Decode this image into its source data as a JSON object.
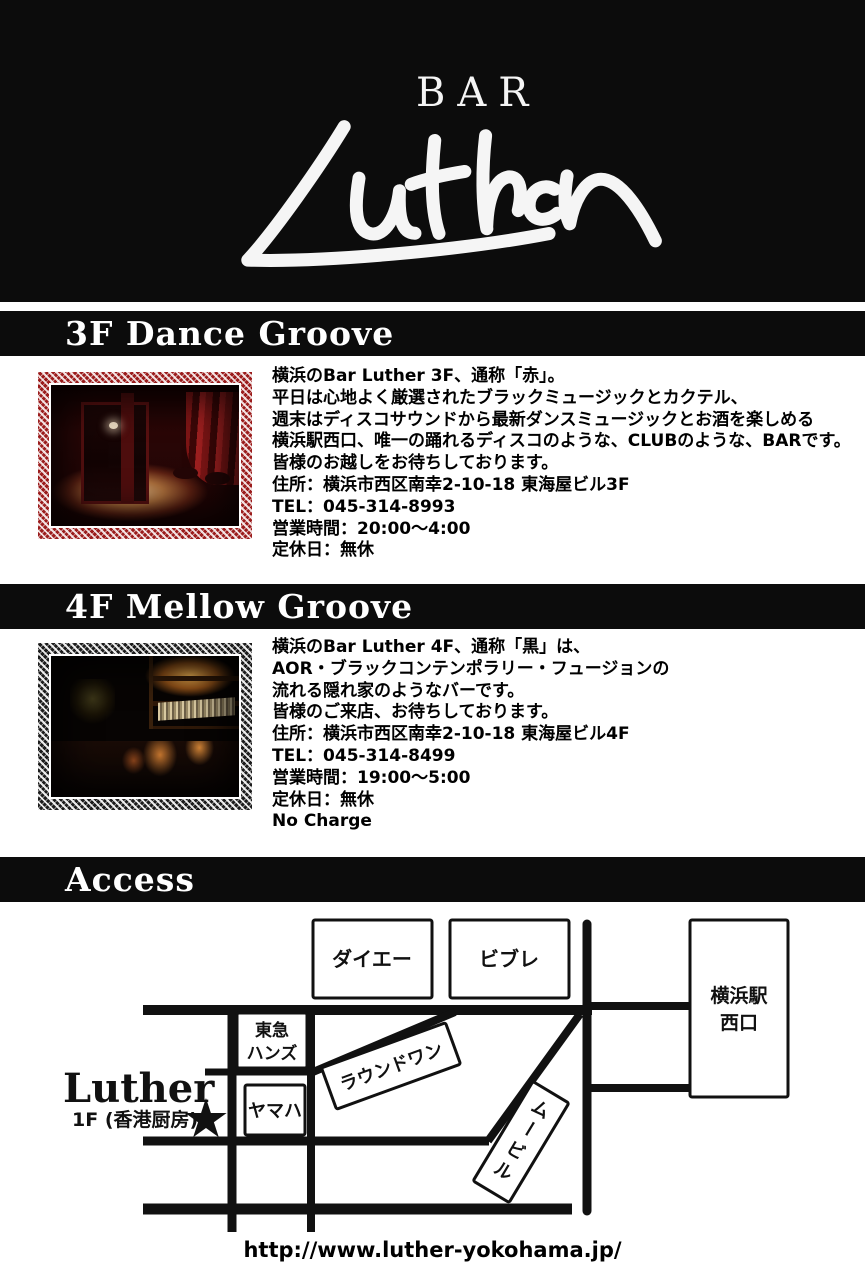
{
  "header": {
    "super_title": "BAR",
    "logo_text": "Luther"
  },
  "sections": {
    "floor3": {
      "title": "3F Dance Groove",
      "lines": [
        "横浜のBar Luther 3F、通称「赤」。",
        "平日は心地よく厳選されたブラックミュージックとカクテル、",
        "週末はディスコサウンドから最新ダンスミュージックとお酒を楽しめる",
        "横浜駅西口、唯一の踊れるディスコのような、CLUBのような、BARです。",
        "皆様のお越しをお待ちしております。",
        "住所：横浜市西区南幸2-10-18 東海屋ビル3F",
        "TEL：045-314-8993",
        "営業時間：20:00～4:00",
        "定休日：無休"
      ]
    },
    "floor4": {
      "title": "4F Mellow Groove",
      "lines": [
        "横浜のBar Luther 4F、通称「黒」は、",
        "AOR・ブラックコンテンポラリー・フュージョンの",
        "流れる隠れ家のようなバーです。",
        "皆様のご来店、お待ちしております。",
        "住所：横浜市西区南幸2-10-18 東海屋ビル4F",
        "TEL：045-314-8499",
        "営業時間：19:00～5:00",
        "定休日：無休",
        "No Charge"
      ]
    },
    "access": {
      "title": "Access"
    }
  },
  "map": {
    "boxes": {
      "daiei": "ダイエー",
      "vivre": "ビブレ",
      "station_line1": "横浜駅",
      "station_line2": "西口",
      "tokyu_line1": "東急",
      "tokyu_line2": "ハンズ",
      "yamaha": "ヤマハ",
      "round_one": "ラウンドワン",
      "movil_chars": [
        "ム",
        "ー",
        "ビ",
        "ル"
      ]
    },
    "luther_label": "Luther",
    "luther_sub": "1F (香港厨房)",
    "star_glyph": "★"
  },
  "footer": {
    "url": "http://www.luther-yokohama.jp/"
  },
  "colors": {
    "ink": "#0c0c0c",
    "paper": "#ffffff",
    "frame_red": "#9b1c1c",
    "frame_dark": "#1c1c1c"
  }
}
